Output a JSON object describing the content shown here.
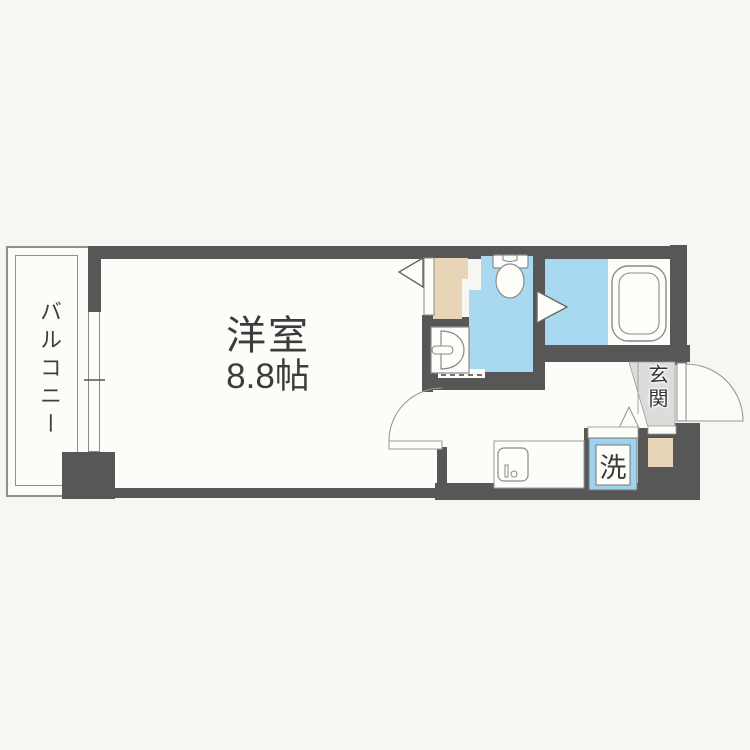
{
  "plan": {
    "type": "apartment-floorplan",
    "rooms": {
      "balcony": {
        "label": "バルコニー"
      },
      "main_room": {
        "label": "洋室",
        "size": "8.8帖"
      },
      "entrance": {
        "label": "玄関"
      },
      "laundry": {
        "label": "洗"
      }
    },
    "fixtures": [
      "toilet",
      "washbasin",
      "bathtub",
      "kitchen-sink",
      "washing-machine-space",
      "closet",
      "shoe-box",
      "entrance-door",
      "room-door",
      "bathroom-door",
      "window"
    ],
    "colors": {
      "wall": "#575757",
      "floor": "#fcfcf9",
      "wet_area_blue": "#a9d8f1",
      "storage_tan": "#e8d5b7",
      "entrance_gray": "#dcdcda",
      "laundry_frame_blue": "#9fd2ec",
      "background": "#f7f6f3",
      "text": "#3c3c3c",
      "outline": "#8a8a8a"
    }
  }
}
